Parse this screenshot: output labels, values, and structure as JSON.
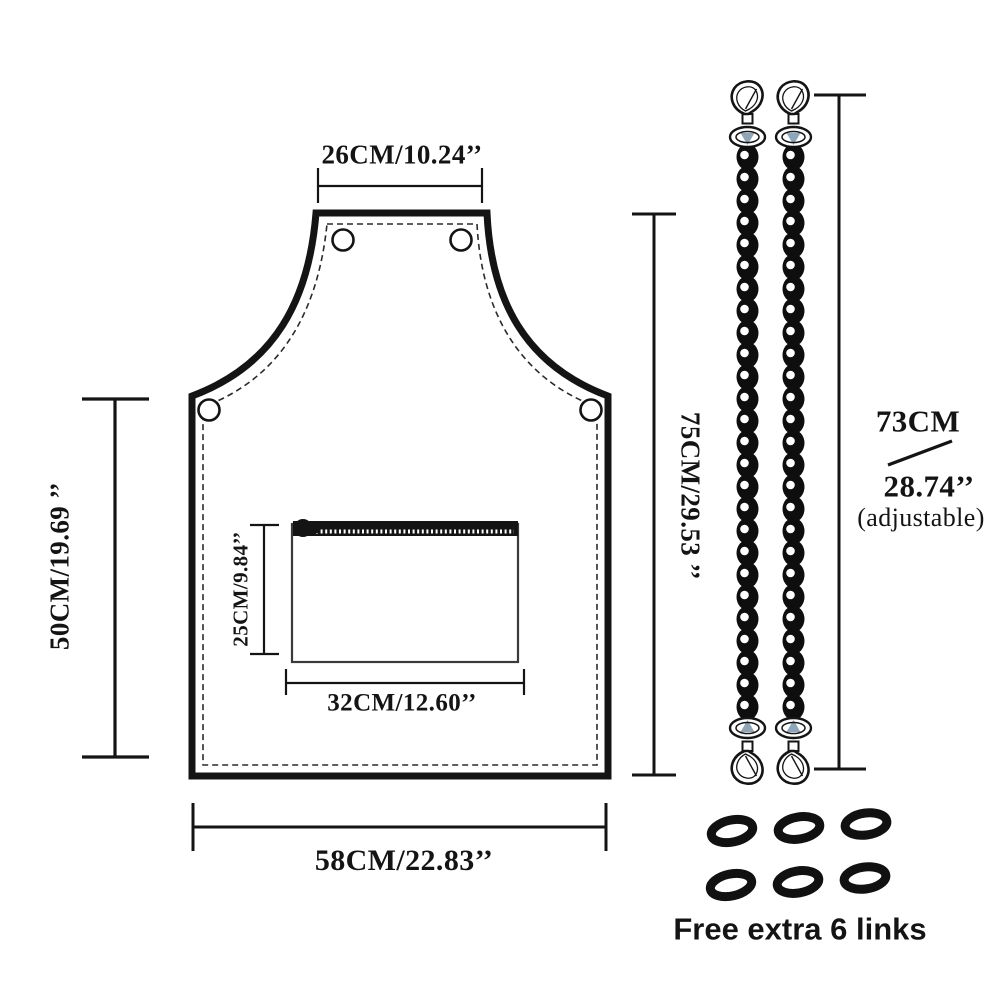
{
  "page": {
    "background": "#ffffff",
    "ink": "#141414",
    "accent_blue": "#8ea6b8"
  },
  "apron": {
    "neck_width_label": "26CM/10.24’’",
    "body_height_label": "50CM/19.69 ’’",
    "total_height_label": "75CM/29.53 ’’",
    "bottom_width_label": "58CM/22.83’’",
    "pocket_height_label": "25CM/9.84’’",
    "pocket_width_label": "32CM/12.60’’"
  },
  "chain_strap": {
    "length_cm_label": "73CM",
    "length_inch_label": "28.74’’",
    "adjustable_label": "(adjustable)"
  },
  "extra_links": {
    "caption": "Free extra 6 links",
    "count": 6
  },
  "icons": {
    "snap_hook": "swivel-snap-hook",
    "chain": "chain-strap",
    "chain_link": "oval-chain-link",
    "grommet": "metal-eyelet",
    "zipper": "zipper-with-pull"
  }
}
